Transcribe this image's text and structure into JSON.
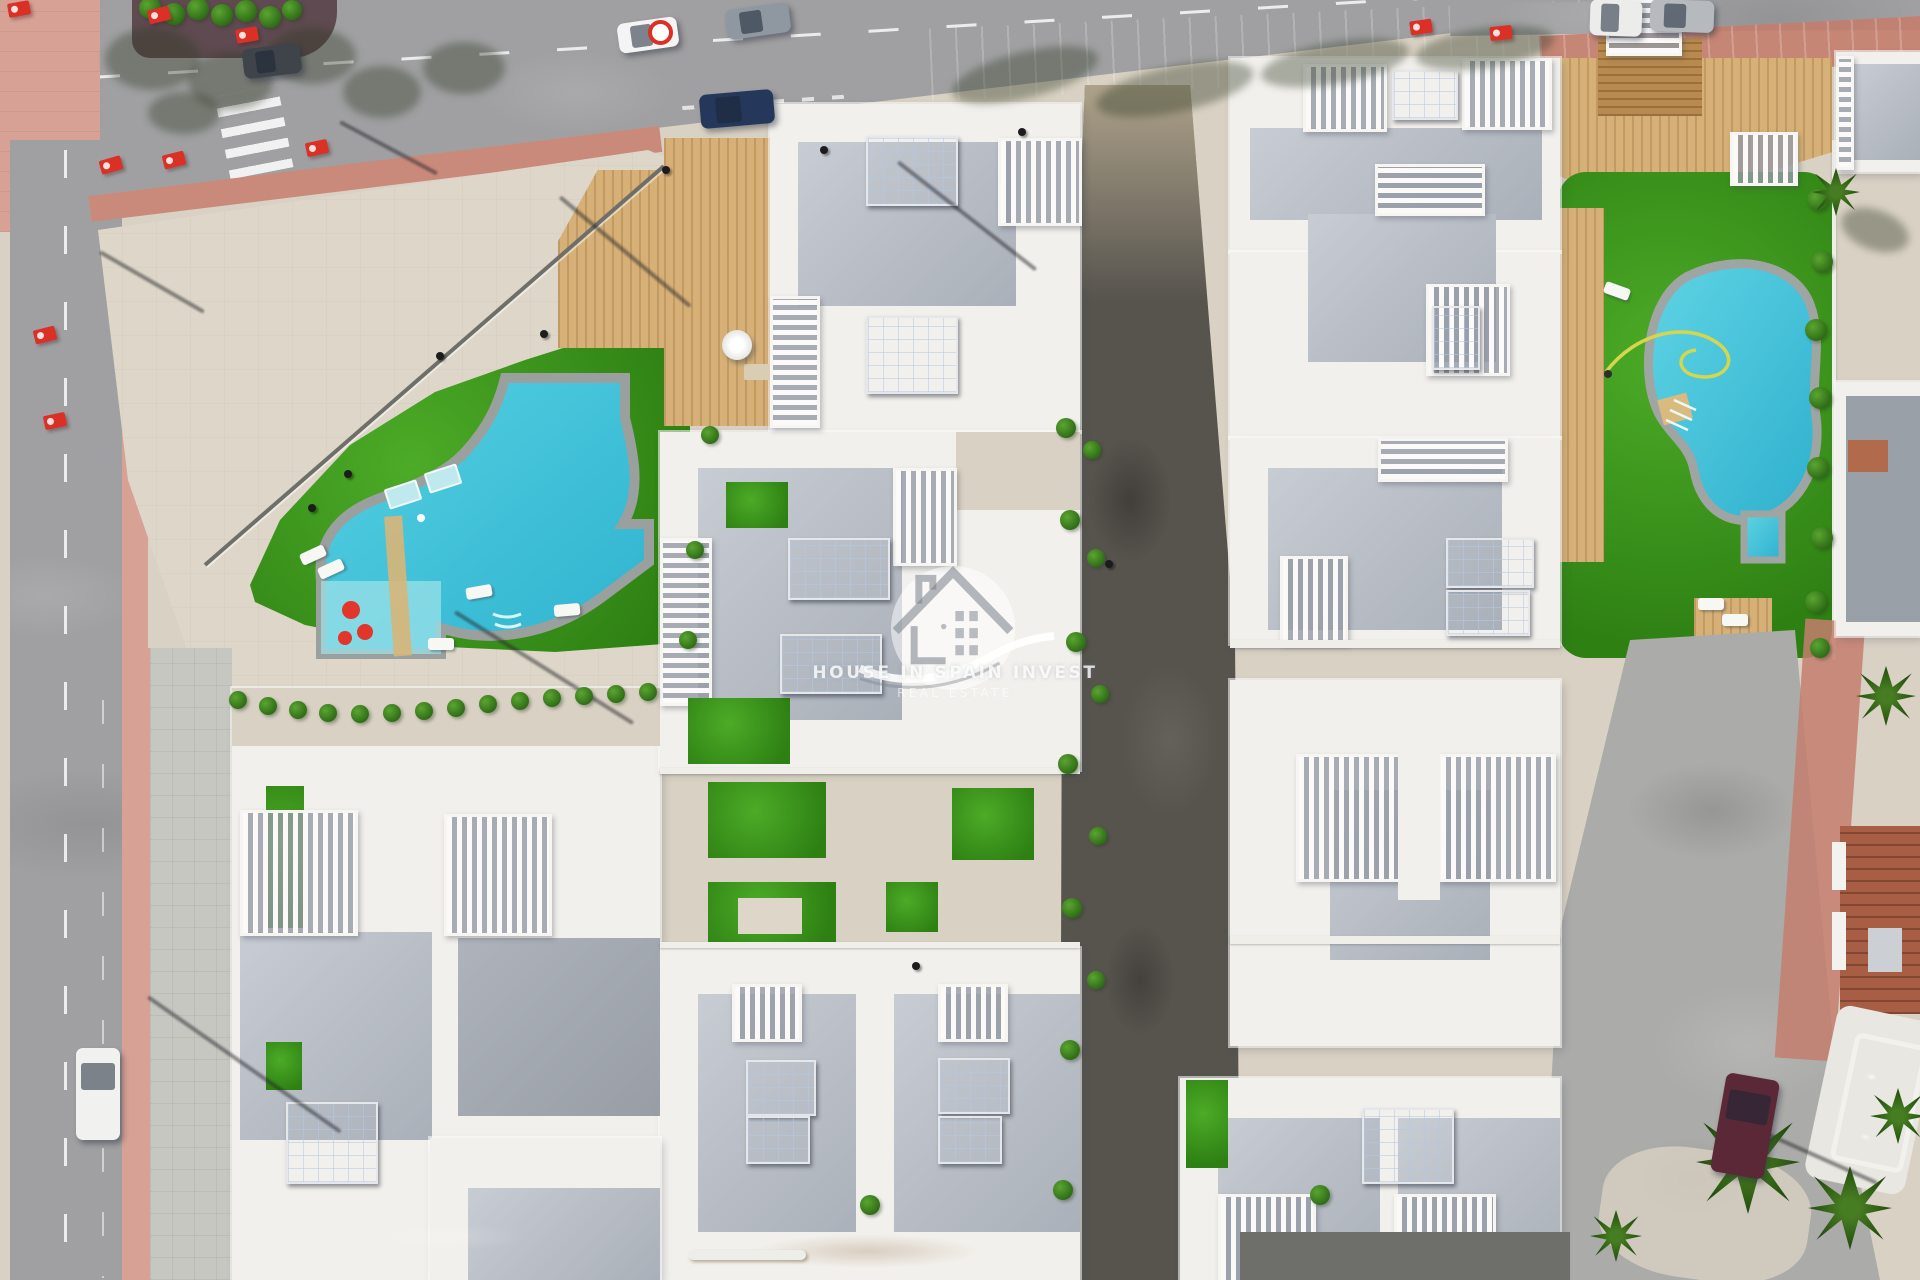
{
  "watermark": {
    "title": "HOUSE IN SPAIN INVEST",
    "subtitle": "REAL ESTATE",
    "icon": "house-in-circle-with-swoosh-logo"
  },
  "palette": {
    "sand": "#d9d1c3",
    "plaza": "#ded7c9",
    "dirt": "#d09a55",
    "road": "#a0a0a2",
    "roadDark": "#57544e",
    "roadRight": "#ababa9",
    "pink": "#d7a195",
    "pinkDeep": "#c98a7b",
    "brick": "#c47e6e",
    "curb": "#5e4a50",
    "lawn": "#3f9d20",
    "pool": "#41c3da",
    "poolLight": "#93e2ea",
    "poolBorder": "#9aa09e",
    "poolBlue": "#2289d8",
    "villa": "#f2f0ec",
    "roof": "#bcc0c7",
    "deck": "#d6b077",
    "deckDark": "#b98a4f",
    "solarPanel": "#17304e",
    "flagRed": "#da3025",
    "treeGreen": "#3c7d20"
  },
  "scene": {
    "flags": [
      {
        "x": 8,
        "y": 2,
        "r": -10
      },
      {
        "x": 148,
        "y": 8,
        "r": -14
      },
      {
        "x": 236,
        "y": 28,
        "r": -10
      },
      {
        "x": 100,
        "y": 158,
        "r": -16
      },
      {
        "x": 163,
        "y": 153,
        "r": -14
      },
      {
        "x": 306,
        "y": 141,
        "r": -12
      },
      {
        "x": 34,
        "y": 328,
        "r": -14
      },
      {
        "x": 44,
        "y": 414,
        "r": -12
      },
      {
        "x": 1410,
        "y": 20,
        "r": -8
      },
      {
        "x": 1490,
        "y": 26,
        "r": -6
      }
    ],
    "cars": [
      {
        "x": 618,
        "y": 20,
        "w": 60,
        "h": 30,
        "r": -8,
        "c": "#f3f4f3",
        "v": false
      },
      {
        "x": 726,
        "y": 6,
        "w": 64,
        "h": 30,
        "r": -8,
        "c": "#8f97a1",
        "v": false
      },
      {
        "x": 700,
        "y": 92,
        "w": 74,
        "h": 34,
        "r": -5,
        "c": "#26375c",
        "v": false
      },
      {
        "x": 243,
        "y": 46,
        "w": 58,
        "h": 30,
        "r": -7,
        "c": "#3f444b",
        "v": false
      },
      {
        "x": 1590,
        "y": 0,
        "w": 52,
        "h": 36,
        "r": 2,
        "c": "#ececea",
        "v": false
      },
      {
        "x": 1650,
        "y": 0,
        "w": 64,
        "h": 32,
        "r": 2,
        "c": "#b6babe",
        "v": false
      },
      {
        "x": 76,
        "y": 1048,
        "w": 44,
        "h": 92,
        "r": 0,
        "c": "#f1f1ef",
        "v": true
      },
      {
        "x": 1718,
        "y": 1076,
        "w": 54,
        "h": 100,
        "r": 10,
        "c": "#5a2836",
        "v": true
      }
    ],
    "markers": [
      {
        "x": 648,
        "y": 20
      }
    ],
    "palms": [
      {
        "x": 1748,
        "y": 1162,
        "r": 52
      },
      {
        "x": 1850,
        "y": 1208,
        "r": 42
      },
      {
        "x": 1898,
        "y": 1116,
        "r": 28
      },
      {
        "x": 1886,
        "y": 696,
        "r": 30
      },
      {
        "x": 1836,
        "y": 192,
        "r": 24
      },
      {
        "x": 1616,
        "y": 1236,
        "r": 26
      }
    ],
    "shrubs": [
      {
        "x": 1066,
        "y": 428,
        "r": 10
      },
      {
        "x": 1092,
        "y": 450,
        "r": 9
      },
      {
        "x": 1070,
        "y": 520,
        "r": 10
      },
      {
        "x": 1096,
        "y": 558,
        "r": 9
      },
      {
        "x": 1076,
        "y": 642,
        "r": 10
      },
      {
        "x": 1100,
        "y": 694,
        "r": 9
      },
      {
        "x": 1068,
        "y": 764,
        "r": 10
      },
      {
        "x": 1098,
        "y": 836,
        "r": 9
      },
      {
        "x": 1072,
        "y": 908,
        "r": 10
      },
      {
        "x": 1096,
        "y": 980,
        "r": 9
      },
      {
        "x": 1070,
        "y": 1050,
        "r": 10
      },
      {
        "x": 870,
        "y": 1205,
        "r": 10
      },
      {
        "x": 1063,
        "y": 1190,
        "r": 10
      },
      {
        "x": 1320,
        "y": 1195,
        "r": 10
      },
      {
        "x": 710,
        "y": 435,
        "r": 9
      },
      {
        "x": 695,
        "y": 550,
        "r": 9
      },
      {
        "x": 688,
        "y": 640,
        "r": 9
      },
      {
        "x": 238,
        "y": 700,
        "r": 9
      },
      {
        "x": 268,
        "y": 706,
        "r": 9
      },
      {
        "x": 298,
        "y": 710,
        "r": 9
      },
      {
        "x": 328,
        "y": 713,
        "r": 9
      },
      {
        "x": 360,
        "y": 714,
        "r": 9
      },
      {
        "x": 392,
        "y": 713,
        "r": 9
      },
      {
        "x": 424,
        "y": 711,
        "r": 9
      },
      {
        "x": 456,
        "y": 708,
        "r": 9
      },
      {
        "x": 488,
        "y": 704,
        "r": 9
      },
      {
        "x": 520,
        "y": 701,
        "r": 9
      },
      {
        "x": 552,
        "y": 698,
        "r": 9
      },
      {
        "x": 584,
        "y": 696,
        "r": 9
      },
      {
        "x": 616,
        "y": 694,
        "r": 9
      },
      {
        "x": 648,
        "y": 692,
        "r": 9
      },
      {
        "x": 1818,
        "y": 200,
        "r": 11
      },
      {
        "x": 1822,
        "y": 262,
        "r": 11
      },
      {
        "x": 1816,
        "y": 330,
        "r": 11
      },
      {
        "x": 1820,
        "y": 398,
        "r": 11
      },
      {
        "x": 1818,
        "y": 468,
        "r": 11
      },
      {
        "x": 1822,
        "y": 538,
        "r": 11
      },
      {
        "x": 1816,
        "y": 602,
        "r": 11
      },
      {
        "x": 1820,
        "y": 648,
        "r": 10
      },
      {
        "x": 150,
        "y": 8,
        "r": 11
      },
      {
        "x": 174,
        "y": 14,
        "r": 11
      },
      {
        "x": 198,
        "y": 9,
        "r": 11
      },
      {
        "x": 222,
        "y": 15,
        "r": 11
      },
      {
        "x": 246,
        "y": 11,
        "r": 11
      },
      {
        "x": 270,
        "y": 17,
        "r": 11
      },
      {
        "x": 292,
        "y": 10,
        "r": 10
      }
    ],
    "loungers": [
      {
        "x": 300,
        "y": 549,
        "r": -25
      },
      {
        "x": 318,
        "y": 563,
        "r": -25
      },
      {
        "x": 466,
        "y": 586,
        "r": -10
      },
      {
        "x": 554,
        "y": 604,
        "r": -5
      },
      {
        "x": 428,
        "y": 638,
        "r": 0
      },
      {
        "x": 1604,
        "y": 285,
        "r": 20
      },
      {
        "x": 1698,
        "y": 598,
        "r": 0
      },
      {
        "x": 1722,
        "y": 614,
        "r": 0
      }
    ],
    "mats": [
      {
        "x": 386,
        "y": 484,
        "r": -18
      },
      {
        "x": 426,
        "y": 468,
        "r": -18
      }
    ],
    "treeShadows": [
      {
        "x": 105,
        "y": 28,
        "w": 95,
        "h": 62,
        "r": 0
      },
      {
        "x": 188,
        "y": 52,
        "w": 85,
        "h": 58,
        "r": 0
      },
      {
        "x": 268,
        "y": 28,
        "w": 88,
        "h": 56,
        "r": 0
      },
      {
        "x": 343,
        "y": 66,
        "w": 78,
        "h": 52,
        "r": 0
      },
      {
        "x": 423,
        "y": 42,
        "w": 82,
        "h": 52,
        "r": 0
      },
      {
        "x": 148,
        "y": 92,
        "w": 72,
        "h": 42,
        "r": 0
      },
      {
        "x": 950,
        "y": 52,
        "w": 150,
        "h": 46,
        "r": -14
      },
      {
        "x": 1095,
        "y": 66,
        "w": 160,
        "h": 46,
        "r": -12
      },
      {
        "x": 1260,
        "y": 42,
        "w": 150,
        "h": 42,
        "r": -10
      },
      {
        "x": 1415,
        "y": 28,
        "w": 140,
        "h": 40,
        "r": -8
      },
      {
        "x": 1840,
        "y": 210,
        "w": 70,
        "h": 40,
        "r": 20
      }
    ],
    "poleShadows": [
      {
        "x": 455,
        "y": 610,
        "l": 210,
        "r": 32
      },
      {
        "x": 560,
        "y": 195,
        "l": 170,
        "r": 40
      },
      {
        "x": 898,
        "y": 160,
        "l": 175,
        "r": 38
      },
      {
        "x": 148,
        "y": 995,
        "l": 235,
        "r": 35
      },
      {
        "x": 1740,
        "y": 1120,
        "l": 150,
        "r": 24
      },
      {
        "x": 100,
        "y": 250,
        "l": 120,
        "r": 30
      },
      {
        "x": 340,
        "y": 120,
        "l": 110,
        "r": 28
      }
    ],
    "dots": [
      {
        "x": 662,
        "y": 166
      },
      {
        "x": 820,
        "y": 146
      },
      {
        "x": 1018,
        "y": 128
      },
      {
        "x": 344,
        "y": 470
      },
      {
        "x": 308,
        "y": 504
      },
      {
        "x": 436,
        "y": 352
      },
      {
        "x": 540,
        "y": 330
      },
      {
        "x": 912,
        "y": 962
      },
      {
        "x": 1105,
        "y": 560
      }
    ]
  }
}
